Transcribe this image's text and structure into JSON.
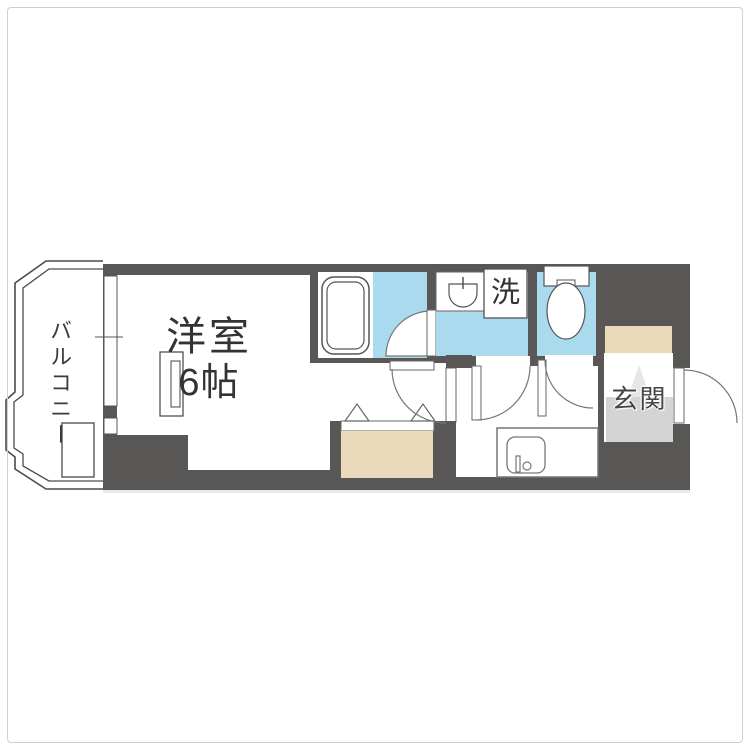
{
  "figure": "apartment-floor-plan",
  "colors": {
    "wall": "#595656",
    "water": "#a9daee",
    "closet": "#ead9ba",
    "genkan_floor": "#d4d4d4",
    "genkan_step": "#e6e6e6",
    "white": "#ffffff"
  },
  "rooms": {
    "main_room": {
      "label": "洋室",
      "size": "6帖"
    },
    "balcony": {
      "label": "バルコニー"
    },
    "entrance": {
      "label": "玄関"
    },
    "laundry": {
      "label": "洗"
    }
  }
}
